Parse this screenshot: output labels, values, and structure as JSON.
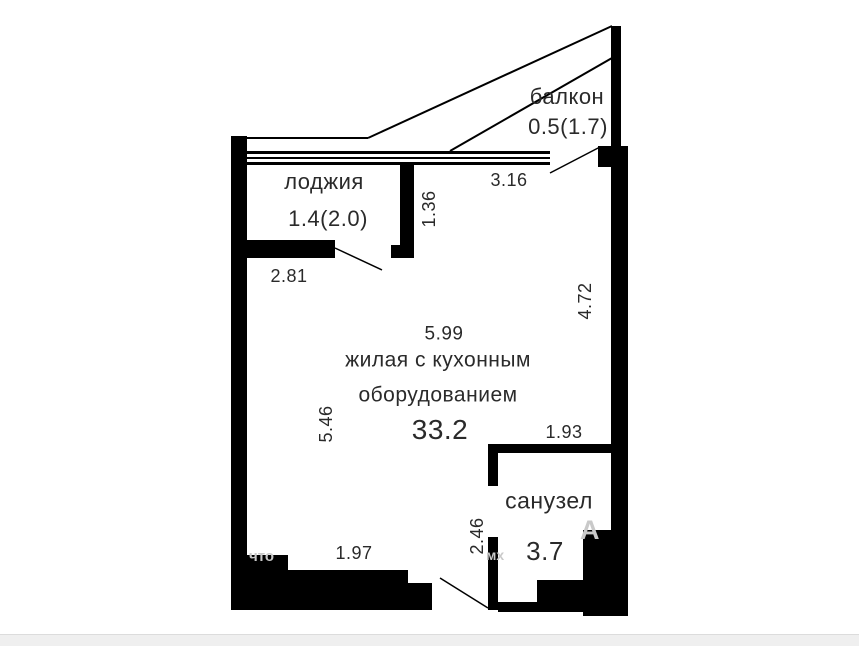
{
  "plan": {
    "balcony": {
      "label": "балкон",
      "area": "0.5(1.7)"
    },
    "loggia": {
      "label": "лоджия",
      "area": "1.4(2.0)"
    },
    "living_room": {
      "label_line1": "жилая с кухонным",
      "label_line2": "оборудованием",
      "area": "33.2"
    },
    "bathroom": {
      "label": "санузел",
      "area": "3.7"
    },
    "dimensions": {
      "balcony_length": "3.16",
      "loggia_width": "2.81",
      "loggia_depth": "1.36",
      "living_width": "5.99",
      "living_depth": "5.46",
      "right_side": "4.72",
      "bathroom_width": "1.93",
      "bathroom_depth": "2.46",
      "bottom_segment": "1.97"
    },
    "watermark_fragments": {
      "f1": "что",
      "f2": "мх",
      "f3": "А"
    },
    "colors": {
      "wall": "#000000",
      "text": "#2a2a2a",
      "watermark": "#c9c9c9",
      "footer_band": "#efefef"
    }
  }
}
